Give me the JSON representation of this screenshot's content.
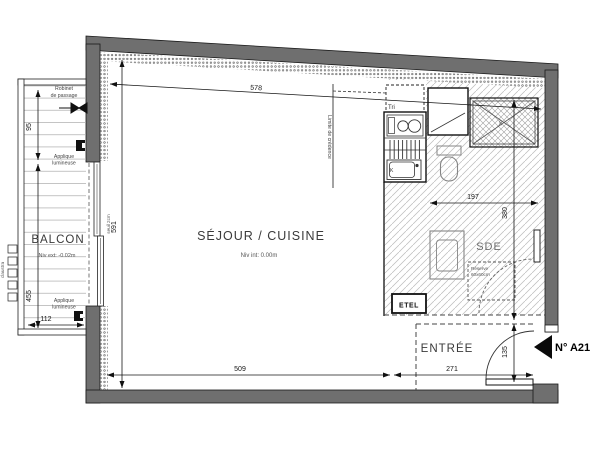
{
  "plan": {
    "unit": {
      "number_label": "N° A21"
    },
    "rooms": {
      "balcon": {
        "name": "BALCON",
        "level": "Niv ext: -0.02m"
      },
      "sejour": {
        "name": "SÉJOUR / CUISINE",
        "level": "Niv int: 0.00m"
      },
      "sde": {
        "name": "SDE"
      },
      "entree": {
        "name": "ENTRÉE"
      },
      "etel": {
        "name": "ETEL"
      }
    },
    "labels": {
      "robinet_l1": "Robinet",
      "robinet_l2": "de passage",
      "applique_l1": "Applique",
      "applique_l2": "lumineuse",
      "seuil": "seuil 2cm",
      "claustra": "claustra",
      "limite": "Limite de crédence",
      "tri": "Tri",
      "sink": "K",
      "ll_l1": "Réserve",
      "ll_l2": "60x60cm",
      "shower": "90"
    },
    "dimensions": {
      "top_width": "578",
      "interior_height": "591",
      "sejour_width": "509",
      "entree_width": "271",
      "sde_width": "197",
      "sde_depth": "380",
      "door_clearance": "135",
      "balcon_width": "112",
      "balcon_depth": "455",
      "balcon_top_seg": "95"
    },
    "colors": {
      "wall": "#6f6f6f",
      "line": "#1a1a1a",
      "hatch": "#bcbcbc",
      "paper": "#ffffff"
    }
  }
}
